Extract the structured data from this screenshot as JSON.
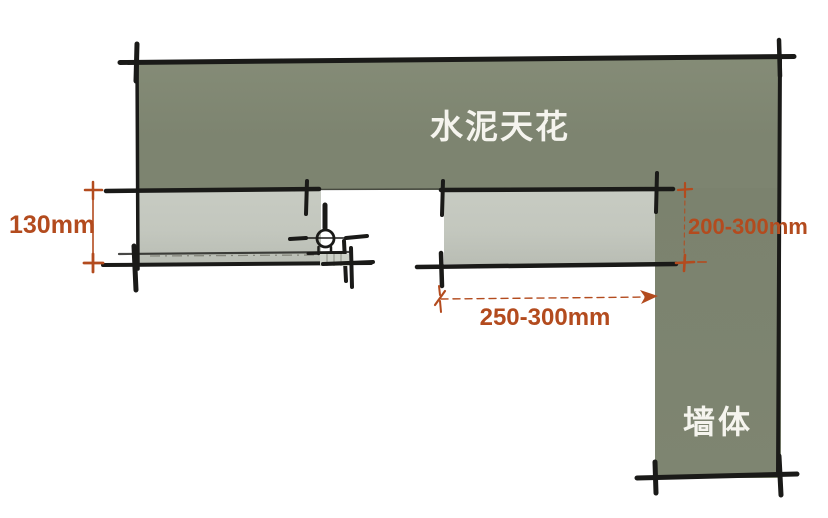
{
  "labels": {
    "ceiling": "水泥天花",
    "wall": "墙体",
    "dim_height": "130mm",
    "dim_wall_offset": "200-300mm",
    "dim_width": "250-300mm"
  },
  "icons": {
    "fixture": "downlight-track-symbol"
  },
  "colors": {
    "ceiling-green": "#7d8470",
    "band-gray": "#c3c7be",
    "ink": "#1a1a18",
    "dim-orange": "#b34b1e",
    "label-white": "#f5f4ee",
    "background": "#ffffff"
  }
}
